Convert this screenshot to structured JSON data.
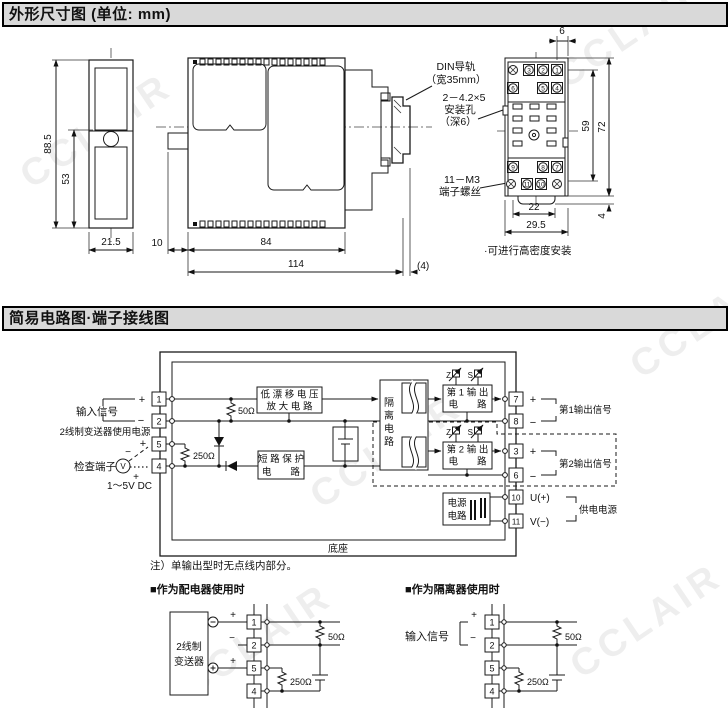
{
  "watermark": "CCLAIR",
  "s1": {
    "title": "外形尺寸图 (单位: mm)",
    "dims": {
      "h_total": "88.5",
      "h_inner": "53",
      "w_front": "21.5",
      "gap": "10",
      "w_body": "84",
      "w_total": "114",
      "rail_depth": "(4)",
      "top6": "6",
      "h59": "59",
      "h72": "72",
      "tab4": "4",
      "w22": "22",
      "w295": "29.5"
    },
    "ann": {
      "din1": "DIN导轨",
      "din2": "（宽35mm）",
      "hole1": "2－4.2×5",
      "hole2": "安装孔",
      "hole3": "（深6）",
      "screw1": "11－M3",
      "screw2": "端子螺丝",
      "note": "·可进行高密度安装"
    },
    "socket": {
      "t3": "3",
      "t2": "2",
      "t1": "1",
      "t6": "6",
      "t5": "5",
      "t4": "4",
      "t9": "9",
      "t8": "8",
      "t7": "7",
      "t11": "11",
      "t10": "10"
    }
  },
  "s2": {
    "title": "简易电路图·端子接线图",
    "left": {
      "input": "输入信号",
      "power": "2线制变送器使用电源",
      "check": "检查端子",
      "vmeter": "V",
      "volt": "1～5V DC"
    },
    "sign": {
      "plus": "+",
      "minus": "−"
    },
    "r": {
      "r50": "50Ω",
      "r250": "250Ω"
    },
    "blocks": {
      "amp1": "低 漂 移 电 压",
      "amp2": "放 大 电 路",
      "sp1": "短 路 保 护",
      "sp2": "电　　路",
      "iso": [
        "隔",
        "离",
        "电",
        "路"
      ],
      "o1a": "第 1 输 出",
      "o1b": "电　　路",
      "o2a": "第 2 输 出",
      "o2b": "电　　路",
      "pw1": "电源",
      "pw2": "电路",
      "z": "Z",
      "s": "S"
    },
    "right": {
      "out1": "第1输出信号",
      "out2": "第2输出信号",
      "supply": "供电电源",
      "u": "U(+)",
      "v": "V(−)"
    },
    "base": "底座",
    "note": "注）单输出型时无点线内部分。",
    "term": {
      "t1": "1",
      "t2": "2",
      "t5": "5",
      "t4": "4",
      "t7": "7",
      "t8": "8",
      "t3": "3",
      "t6": "6",
      "t10": "10",
      "t11": "11"
    },
    "sub1": {
      "title": "■作为配电器使用时",
      "tx1": "2线制",
      "tx2": "变送器"
    },
    "sub2": {
      "title": "■作为隔离器使用时",
      "input": "输入信号"
    }
  }
}
